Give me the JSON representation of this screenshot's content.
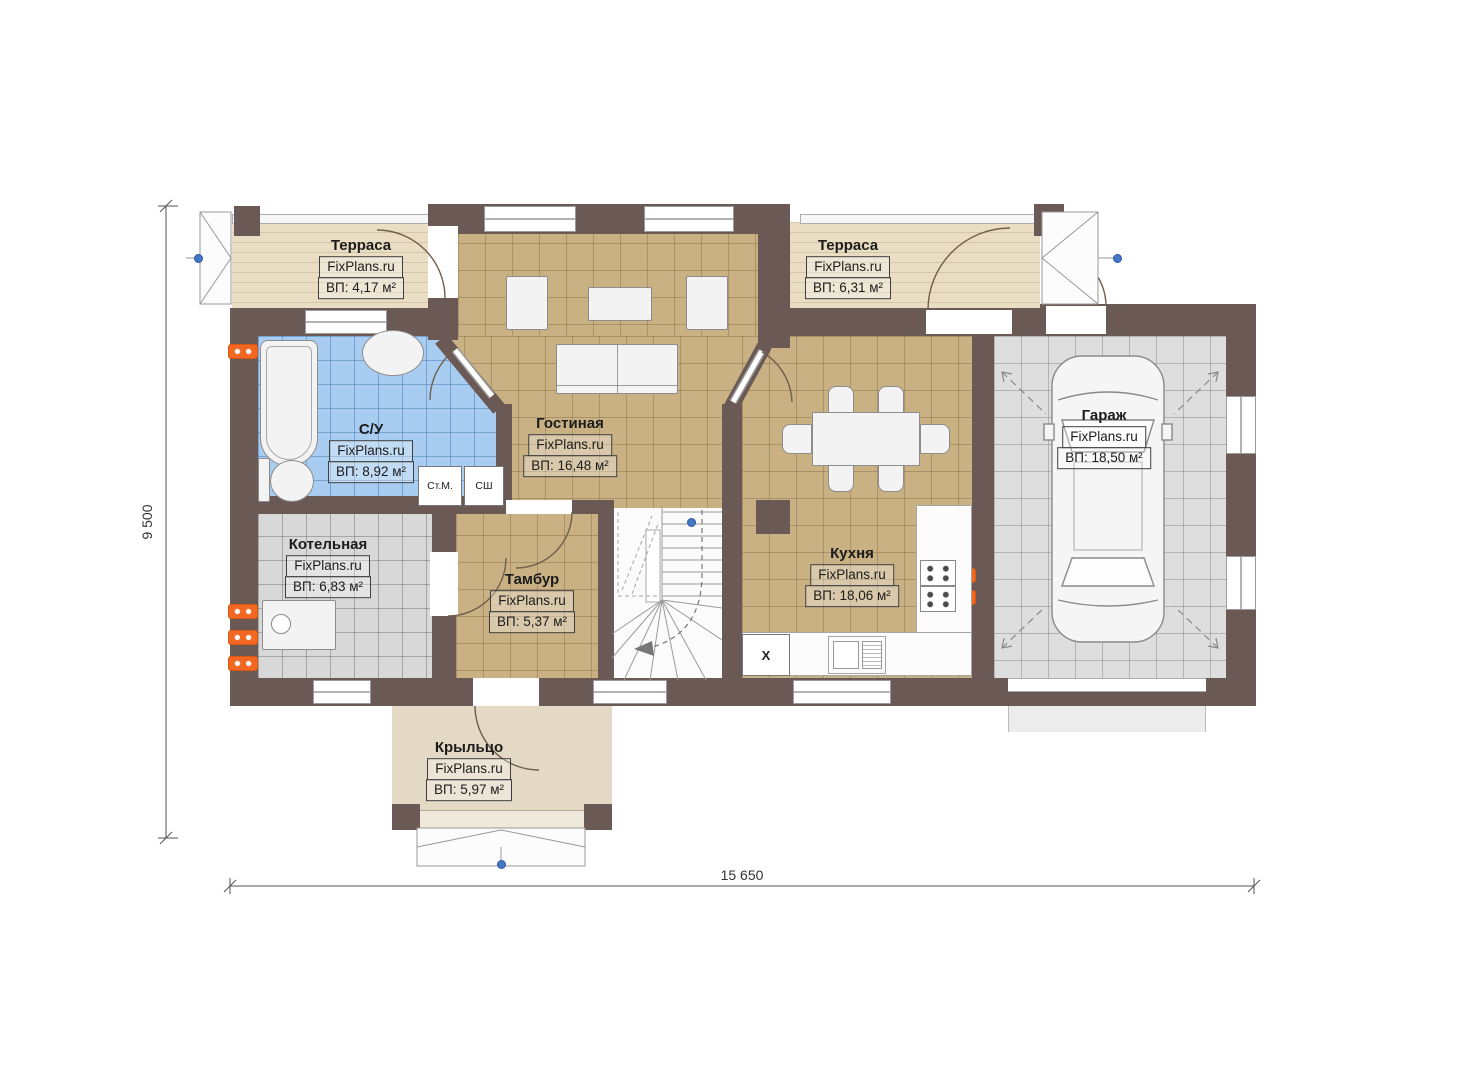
{
  "dims": {
    "height_label": "9 500",
    "width_label": "15 650"
  },
  "brand": {
    "watermark": "FixPlans.ru"
  },
  "rooms": [
    {
      "id": "terrace-left",
      "name": "Терраса",
      "watermark": "FixPlans.ru",
      "area": "ВП: 4,17 м²"
    },
    {
      "id": "terrace-right",
      "name": "Терраса",
      "watermark": "FixPlans.ru",
      "area": "ВП: 6,31 м²"
    },
    {
      "id": "bathroom",
      "name": "С/У",
      "watermark": "FixPlans.ru",
      "area": "ВП: 8,92 м²"
    },
    {
      "id": "living-room",
      "name": "Гостиная",
      "watermark": "FixPlans.ru",
      "area": "ВП: 16,48 м²"
    },
    {
      "id": "boiler-room",
      "name": "Котельная",
      "watermark": "FixPlans.ru",
      "area": "ВП: 6,83 м²"
    },
    {
      "id": "vestibule",
      "name": "Тамбур",
      "watermark": "FixPlans.ru",
      "area": "ВП: 5,37 м²"
    },
    {
      "id": "kitchen",
      "name": "Кухня",
      "watermark": "FixPlans.ru",
      "area": "ВП: 18,06 м²"
    },
    {
      "id": "garage",
      "name": "Гараж",
      "watermark": "FixPlans.ru",
      "area": "ВП: 18,50 м²"
    },
    {
      "id": "porch",
      "name": "Крыльцо",
      "watermark": "FixPlans.ru",
      "area": "ВП: 5,97 м²"
    }
  ],
  "labels": {
    "washing_machine": "Ст.М.",
    "dryer": "СШ",
    "fridge_mark": "X"
  },
  "colors": {
    "wall": "#6a5955",
    "terrace_floor": "#e9ddc3",
    "room_tan": "#c9b184",
    "bathroom_blue": "#a9cdf1",
    "utility_gray": "#d8d8d8",
    "garage_gray": "#dedede",
    "porch_floor": "#e4d9c5",
    "radiator_orange": "#f26722",
    "marker_blue": "#4477c4"
  }
}
